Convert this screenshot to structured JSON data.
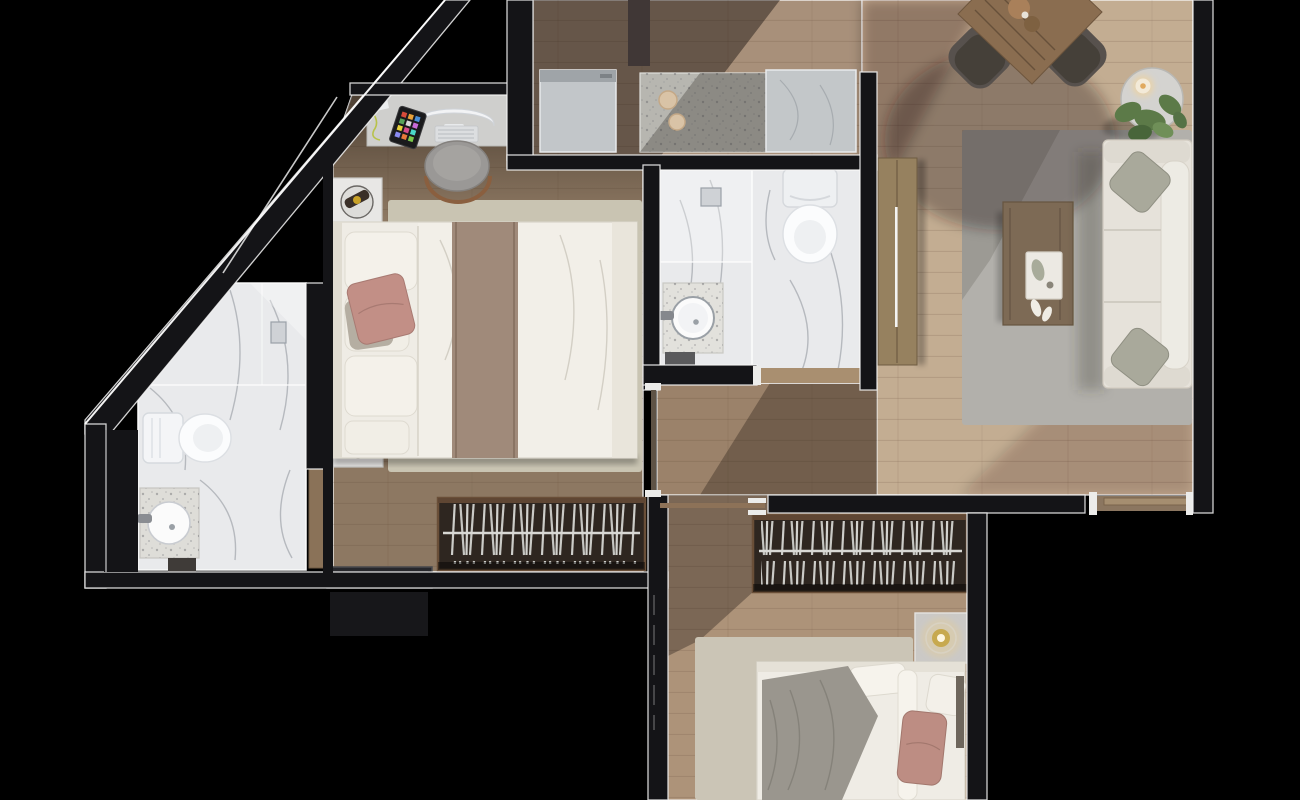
{
  "scene": {
    "kind": "apartment-floor-plan-3d-render-top-view",
    "background": "#000000",
    "rooms": [
      {
        "id": "master-bedroom",
        "furniture": [
          "desk",
          "computer-monitor",
          "keyboard",
          "tablet",
          "desk-chair",
          "nightstand-left-top",
          "nightstand-left-bottom",
          "double-bed",
          "area-rug",
          "wardrobe-with-hangers",
          "window"
        ]
      },
      {
        "id": "bathroom-left",
        "furniture": [
          "toilet",
          "sink-vanity",
          "shower-drain",
          "wood-door"
        ]
      },
      {
        "id": "kitchen",
        "furniture": [
          "appliance-block",
          "terrazzo-counter-with-burners",
          "counter-block",
          "tall-cabinet"
        ]
      },
      {
        "id": "bathroom-middle",
        "furniture": [
          "toilet",
          "sink-vanity",
          "shower-drain",
          "bath-mat"
        ]
      },
      {
        "id": "living-dining",
        "furniture": [
          "dining-table",
          "dining-chair",
          "dining-chair",
          "plant-side-table",
          "candle",
          "tv-cabinet",
          "area-rug",
          "coffee-table",
          "tray",
          "sofa",
          "sofa-pillow",
          "sofa-pillow",
          "door-threshold"
        ]
      },
      {
        "id": "hallway",
        "furniture": [
          "sliding-door-track"
        ]
      },
      {
        "id": "bedroom-2",
        "furniture": [
          "wardrobe-with-hangers",
          "nightstand-with-lamp",
          "double-bed",
          "gray-blanket",
          "pink-pillow",
          "area-rug"
        ]
      }
    ]
  },
  "palette": {
    "background": "#000000",
    "wall": "#141417",
    "wallSeam": "#f2f2f2",
    "floorLiving": "#c3ad92",
    "floorKitchen": "#a8907a",
    "floorMaster": "#8d7862",
    "floorHall": "#9b826a",
    "floorBedroom2": "#ad9379",
    "marble": "#e9eaec",
    "terrazzoCounter": "#b7b6b0",
    "rugLiving": "#b2b0ab",
    "rugMaster": "#c9c4b2",
    "rugBedroom2": "#cbc5b6",
    "bedLinen": "#efece5",
    "bedRunner": "#a08a7a",
    "pillowPink": "#c28f86",
    "pillowPink2": "#bd8d83",
    "blanketGray": "#9a968e",
    "sofa": "#e6e2da",
    "sofaPillow": "#a9a99b",
    "diningWood": "#8a6d50",
    "coffeeTable": "#7d6a55",
    "tvCabinet": "#96815f",
    "wardrobeDark": "#2e2620",
    "wardrobeWood": "#5f4633",
    "applianceGray": "#c2c6c9",
    "plantGreen": "#5c7a48",
    "lampGold": "#c7a94f",
    "doorWood": "#8a7258",
    "chairGray": "#57514d",
    "porcelain": "#f4f5f7"
  }
}
